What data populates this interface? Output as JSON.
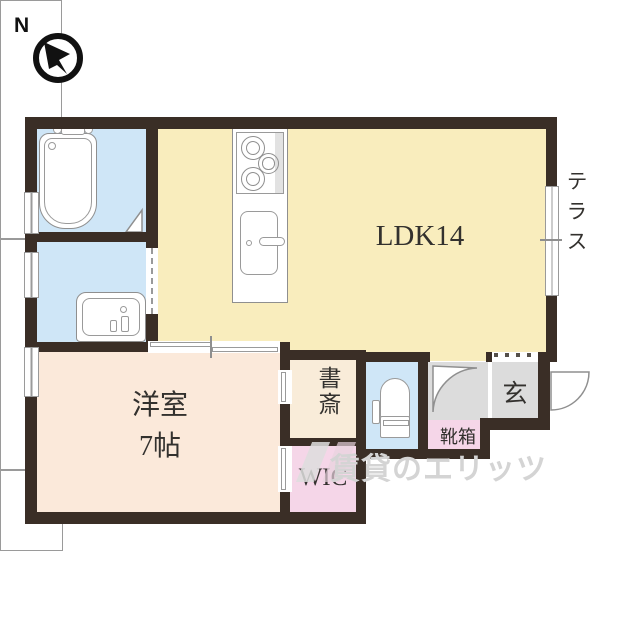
{
  "compass": {
    "north_label": "N"
  },
  "labels": {
    "ldk": "LDK14",
    "western_room_name": "洋室",
    "western_room_size": "7帖",
    "study": "書斎",
    "wic": "WIC",
    "terrace": "テラス",
    "entrance": "玄",
    "shoe_cabinet": "靴箱"
  },
  "watermark": {
    "text": "賃貸のエリッツ"
  },
  "colors": {
    "wall": "#3a2e26",
    "ldk_floor": "#f9edbd",
    "western_room_floor": "#fbe9da",
    "wet_area_floor": "#cfe6f7",
    "closet_pink": "#f5d6e8",
    "study_floor": "#f9ecd9",
    "hall_gray": "#dcdcdc",
    "fixture_outline": "#8f8f8f",
    "watermark_gray": "#d4d4d4"
  }
}
